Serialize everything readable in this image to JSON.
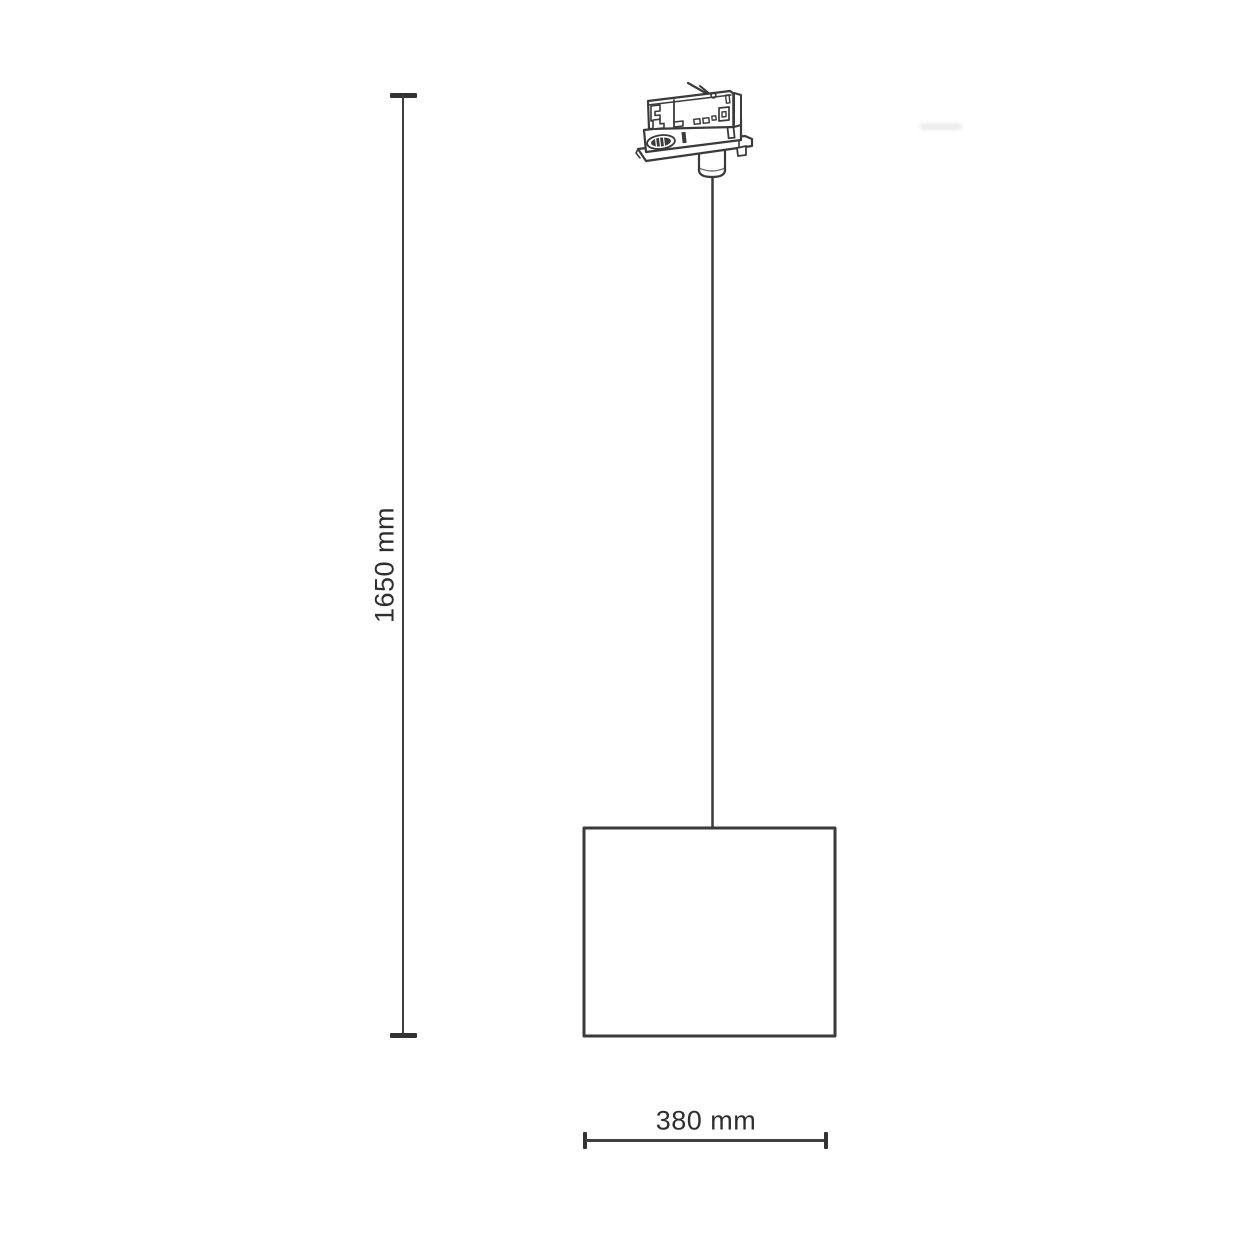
{
  "page": {
    "background": "#ffffff"
  },
  "diagram": {
    "type": "product-dimension-line-drawing",
    "subject": "track-mounted pendant lamp",
    "line_color": "#3a3a3a",
    "text_color": "#2e2e2e",
    "height_dimension": {
      "label": "1650 mm"
    },
    "width_dimension": {
      "label": "380 mm"
    },
    "parts": [
      "three-phase track adapter",
      "suspension cable",
      "cylindrical lampshade"
    ]
  }
}
